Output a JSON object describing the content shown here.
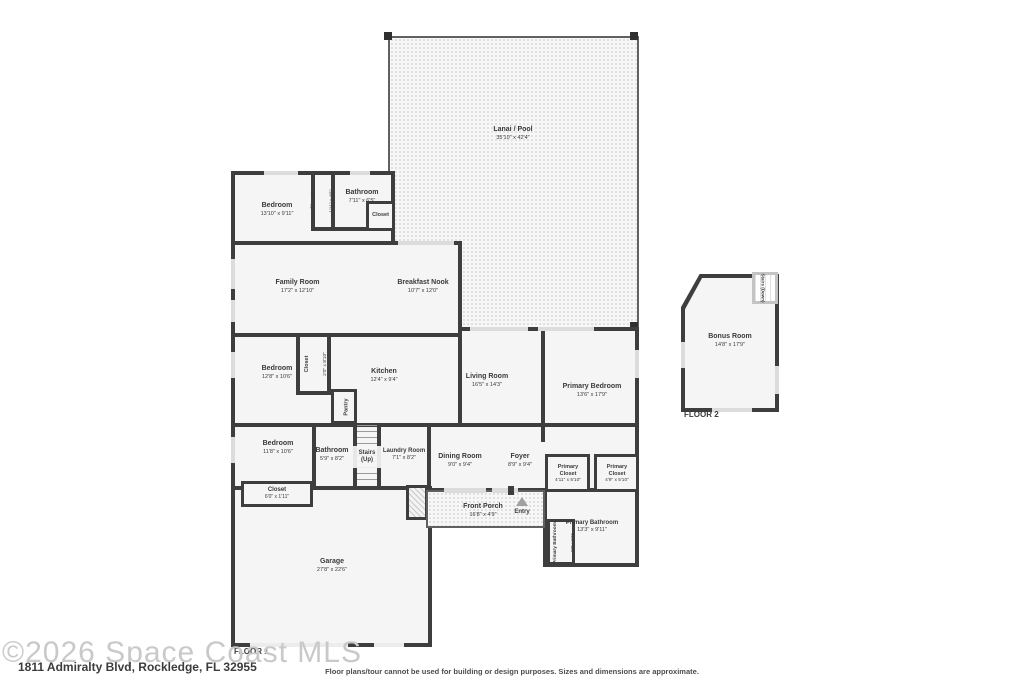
{
  "watermark": "©2026 Space Coast MLS",
  "address": "1811 Admiralty Blvd, Rockledge, FL 32955",
  "disclaimer": "Floor plans/tour cannot be used for building or design purposes. Sizes and dimensions are approximate.",
  "floor_labels": {
    "floor1": "FLOOR 1",
    "floor2": "FLOOR 2"
  },
  "rooms": {
    "lanai": {
      "name": "Lanai / Pool",
      "dims": "35'10\" x 42'4\""
    },
    "bedroom_top": {
      "name": "Bedroom",
      "dims": "13'10\" x 9'11\""
    },
    "closet_top": {
      "name": "Closet",
      "dims": "1'11\" x 4'5\""
    },
    "bathroom_top": {
      "name": "Bathroom",
      "dims": "7'11\" x 6'5\""
    },
    "closet_bath": {
      "name": "Closet"
    },
    "family_room": {
      "name": "Family Room",
      "dims": "17'2\" x 12'10\""
    },
    "breakfast_nook": {
      "name": "Breakfast Nook",
      "dims": "10'7\" x 12'0\""
    },
    "bedroom_mid": {
      "name": "Bedroom",
      "dims": "12'8\" x 10'6\""
    },
    "closet_mid": {
      "name": "Closet",
      "dims": "2'0\" x 8'10\""
    },
    "pantry": {
      "name": "Pantry"
    },
    "kitchen": {
      "name": "Kitchen",
      "dims": "12'4\" x 9'4\""
    },
    "living_room": {
      "name": "Living Room",
      "dims": "16'5\" x 14'3\""
    },
    "primary_bedroom": {
      "name": "Primary Bedroom",
      "dims": "13'6\" x 17'9\""
    },
    "bedroom_bottom": {
      "name": "Bedroom",
      "dims": "11'8\" x 10'6\""
    },
    "bathroom_bottom": {
      "name": "Bathroom",
      "dims": "5'9\" x 8'2\""
    },
    "stairs_up": {
      "name": "Stairs",
      "dims": "(Up)"
    },
    "laundry_room": {
      "name": "Laundry Room",
      "dims": "7'1\" x 8'2\""
    },
    "closet_hall": {
      "name": "Closet",
      "dims": "6'0\" x 1'11\""
    },
    "dining_room": {
      "name": "Dining Room",
      "dims": "9'0\" x 9'4\""
    },
    "foyer": {
      "name": "Foyer",
      "dims": "8'9\" x 9'4\""
    },
    "primary_closet_left": {
      "name": "Primary Closet",
      "dims": "4'11\" x 5'10\""
    },
    "primary_closet_right": {
      "name": "Primary Closet",
      "dims": "4'9\" x 5'10\""
    },
    "front_porch": {
      "name": "Front Porch",
      "dims": "16'8\" x 4'9\""
    },
    "entry": {
      "name": "Entry"
    },
    "primary_bathroom": {
      "name": "Primary Bathroom",
      "dims": "13'3\" x 9'11\""
    },
    "primary_bathroom_wc": {
      "name": "Primary Bathroom",
      "dims": "2'7\" x 5'5\""
    },
    "garage": {
      "name": "Garage",
      "dims": "27'8\" x 22'6\""
    },
    "bonus_room": {
      "name": "Bonus Room",
      "dims": "14'8\" x 17'9\""
    },
    "stairs_down": {
      "name": "Stairs (Down)"
    }
  },
  "colors": {
    "wall": "#3e3e3e",
    "room_fill": "#f5f5f5",
    "label_text": "#3a3a3a",
    "watermark": "#c9c9c9"
  }
}
